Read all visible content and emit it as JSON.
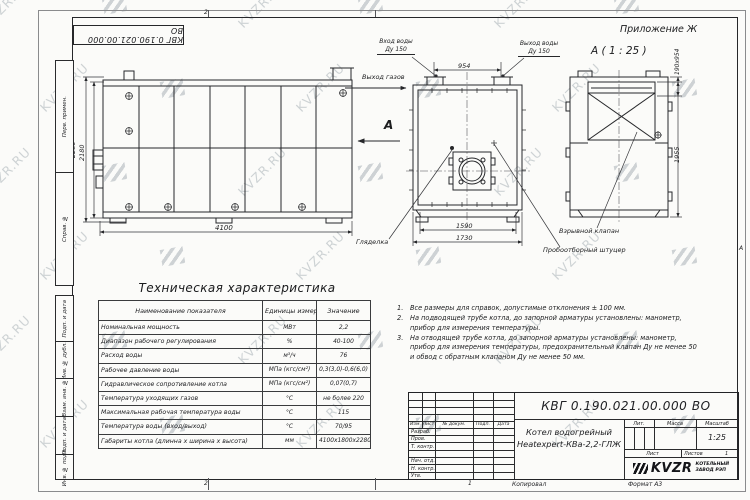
{
  "sheet": {
    "watermark_text": "KVZR.RU",
    "doc_number": "КВГ 0.190.021.00.000 ВО",
    "appendix_label": "Приложение Ж",
    "zone_top": "2",
    "zone_bottom": "2",
    "sheet_marker": "1",
    "zone_right_letter": "А",
    "copied_label": "Копировал",
    "format_label": "Формат А3"
  },
  "margin": {
    "labels": [
      "Перв. примен.",
      "Справ. №",
      "Подп. и дата",
      "Инв. № дубл.",
      "Взам. инв. №",
      "Подп. и дата",
      "Инв. № подл."
    ]
  },
  "drawing": {
    "view_a_title": "А ( 1 : 25 )",
    "section_arrow_label": "А",
    "labels": {
      "water_in_1": "Вход воды",
      "water_in_2": "Ду 150",
      "water_out_1": "Выход воды",
      "water_out_2": "Ду 150",
      "gas_out": "Выход газов",
      "sight_glass": "Гляделка",
      "explosion_valve": "Взрывной клапан",
      "sampling_fitting": "Пробоотборный штуцер"
    },
    "dims": {
      "length": "4100",
      "height_outer": "2280",
      "height_inner": "2180",
      "stub_spacing": "954",
      "width_inner": "1590",
      "width_outer": "1730",
      "flue_size": "190х954",
      "rear_height": "1955"
    }
  },
  "tech_table": {
    "title": "Техническая характеристика",
    "headers": [
      "Наименование показателя",
      "Единицы измерения",
      "Значение"
    ],
    "rows": [
      [
        "Номинальная мощность",
        "МВт",
        "2,2"
      ],
      [
        "Диапазон рабочего регулирования",
        "%",
        "40-100"
      ],
      [
        "Расход воды",
        "м³/ч",
        "76"
      ],
      [
        "Рабочее давление воды",
        "МПа (кгс/см²)",
        "0,3(3,0)-0,6(6,0)"
      ],
      [
        "Гидравлическое сопротивление котла",
        "МПа (кгс/см²)",
        "0,07(0,7)"
      ],
      [
        "Температура уходящих газов",
        "°С",
        "не более 220"
      ],
      [
        "Максимальная рабочая температура воды",
        "°С",
        "115"
      ],
      [
        "Температура воды (вход/выход)",
        "°С",
        "70/95"
      ],
      [
        "Габариты котла (длинна х ширина х высота)",
        "мм",
        "4100х1800х2280"
      ]
    ]
  },
  "notes": [
    {
      "num": "1.",
      "text": "Все размеры для справок, допустимые отклонения ± 100 мм."
    },
    {
      "num": "2.",
      "text": "На подводящей трубе котла, до запорной арматуры установлены: манометр, прибор для измерения температуры."
    },
    {
      "num": "3.",
      "text": "На отводящей трубе котла, до запорной арматуры установлены: манометр, прибор для измерения температуры, предохранительный клапан Ду не менее 50 и обвод с обратным клапаном Ду не менее 50 мм."
    }
  ],
  "title_block": {
    "doc_number": "КВГ 0.190.021.00.000 ВО",
    "product_line1": "Котел водогрейный",
    "product_line2": "Heatexpert-КВа-2,2-ГЛЖ",
    "rev_headers": [
      "Изм.",
      "Лист",
      "№ докум.",
      "Подп.",
      "Дата"
    ],
    "sig_rows": [
      "Разраб.",
      "Пров.",
      "Т. контр.",
      "Нач. отд.",
      "Н. контр.",
      "Утв."
    ],
    "lit_label": "Лит.",
    "mass_label": "Масса",
    "scale_label": "Масштаб",
    "scale_value": "1:25",
    "sheet_label": "Лист",
    "sheets_label": "Листов",
    "sheets_value": "1",
    "logo_text": "KVZR",
    "logo_sub1": "КОТЕЛЬНЫЙ",
    "logo_sub2": "ЗАВОД РЭП"
  }
}
